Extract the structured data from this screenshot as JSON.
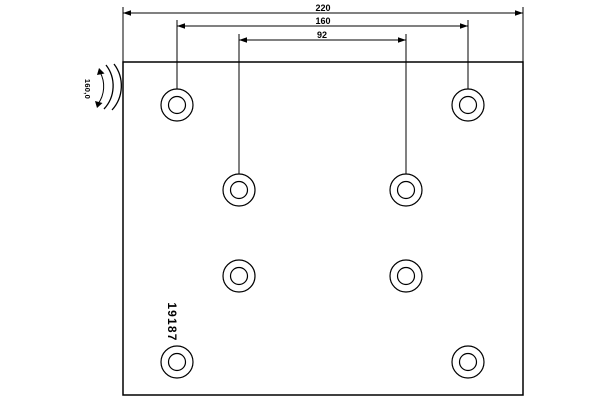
{
  "drawing": {
    "background_color": "#ffffff",
    "line_color": "#000000",
    "part": {
      "number": "19187",
      "radius_label": "160,0"
    },
    "dimensions": {
      "overall_width": "220",
      "outer_hole_spacing": "160",
      "inner_hole_spacing": "92"
    },
    "plate": {
      "x": 123,
      "y": 62,
      "width": 400,
      "height": 333
    },
    "holes": {
      "count": 8,
      "outer_radius": 16,
      "inner_radius": 8.5,
      "centers": [
        {
          "x": 177,
          "y": 105
        },
        {
          "x": 468,
          "y": 105
        },
        {
          "x": 239,
          "y": 190
        },
        {
          "x": 406,
          "y": 190
        },
        {
          "x": 239,
          "y": 276
        },
        {
          "x": 406,
          "y": 276
        },
        {
          "x": 177,
          "y": 362
        },
        {
          "x": 468,
          "y": 362
        }
      ]
    }
  }
}
